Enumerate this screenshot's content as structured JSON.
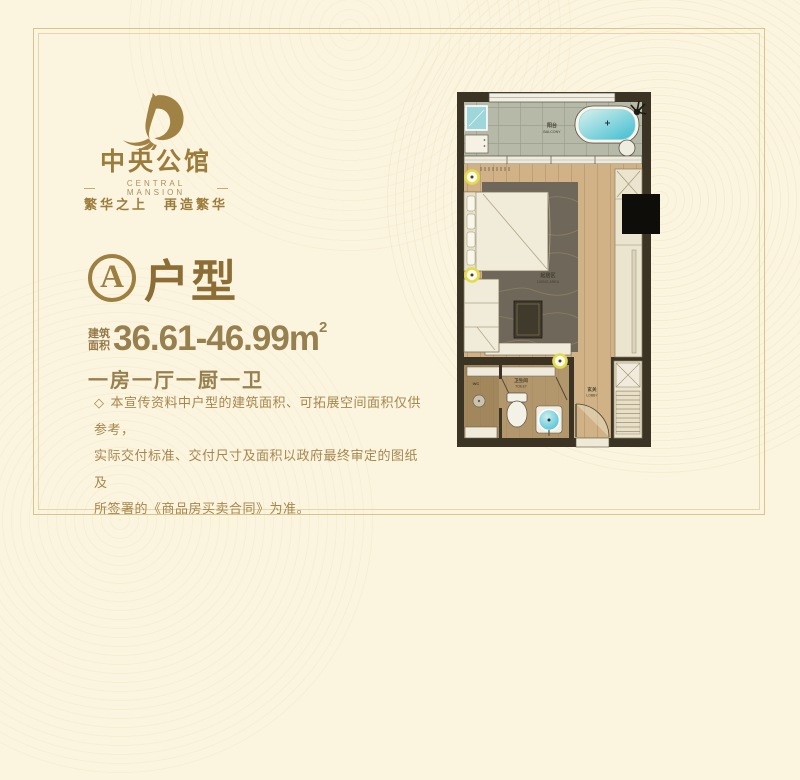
{
  "brand": {
    "name_cn": "中央公馆",
    "name_en": "CENTRAL MANSION",
    "tagline": "繁华之上　再造繁华"
  },
  "unit": {
    "badge_letter": "A",
    "type_label": "户型",
    "area_label_top": "建筑",
    "area_label_bottom": "面积",
    "area_value": "36.61-46.99m",
    "area_superscript": "2",
    "layout_text": "一房一厅一厨一卫"
  },
  "disclaimer": {
    "bullet": "◇",
    "lines": [
      "本宣传资料中户型的建筑面积、可拓展空间面积仅供参考，",
      "实际交付标准、交付尺寸及面积以政府最终审定的图纸及",
      "所签署的《商品房买卖合同》为准。"
    ]
  },
  "floorplan": {
    "labels": {
      "balcony_cn": "阳台",
      "balcony_en": "BALCONY",
      "living_cn": "起居区",
      "living_en": "LIVING AREA",
      "toilet_cn": "卫生间",
      "toilet_en": "TOILET",
      "lobby_cn": "玄关",
      "lobby_en": "LOBBY",
      "wc": "WC"
    }
  },
  "colors": {
    "gold": "#9b7c3b",
    "text_gold": "#97804f",
    "background": "#fbf4df",
    "frame": "#d9c48e",
    "wall_dark": "#3b3424",
    "wood_floor": "#d0b286",
    "balcony_tile": "#b6b9a8",
    "water_cyan": "#5ecbdc",
    "rug": "#6e675a",
    "ring_yellow": "#e2dc4d"
  }
}
